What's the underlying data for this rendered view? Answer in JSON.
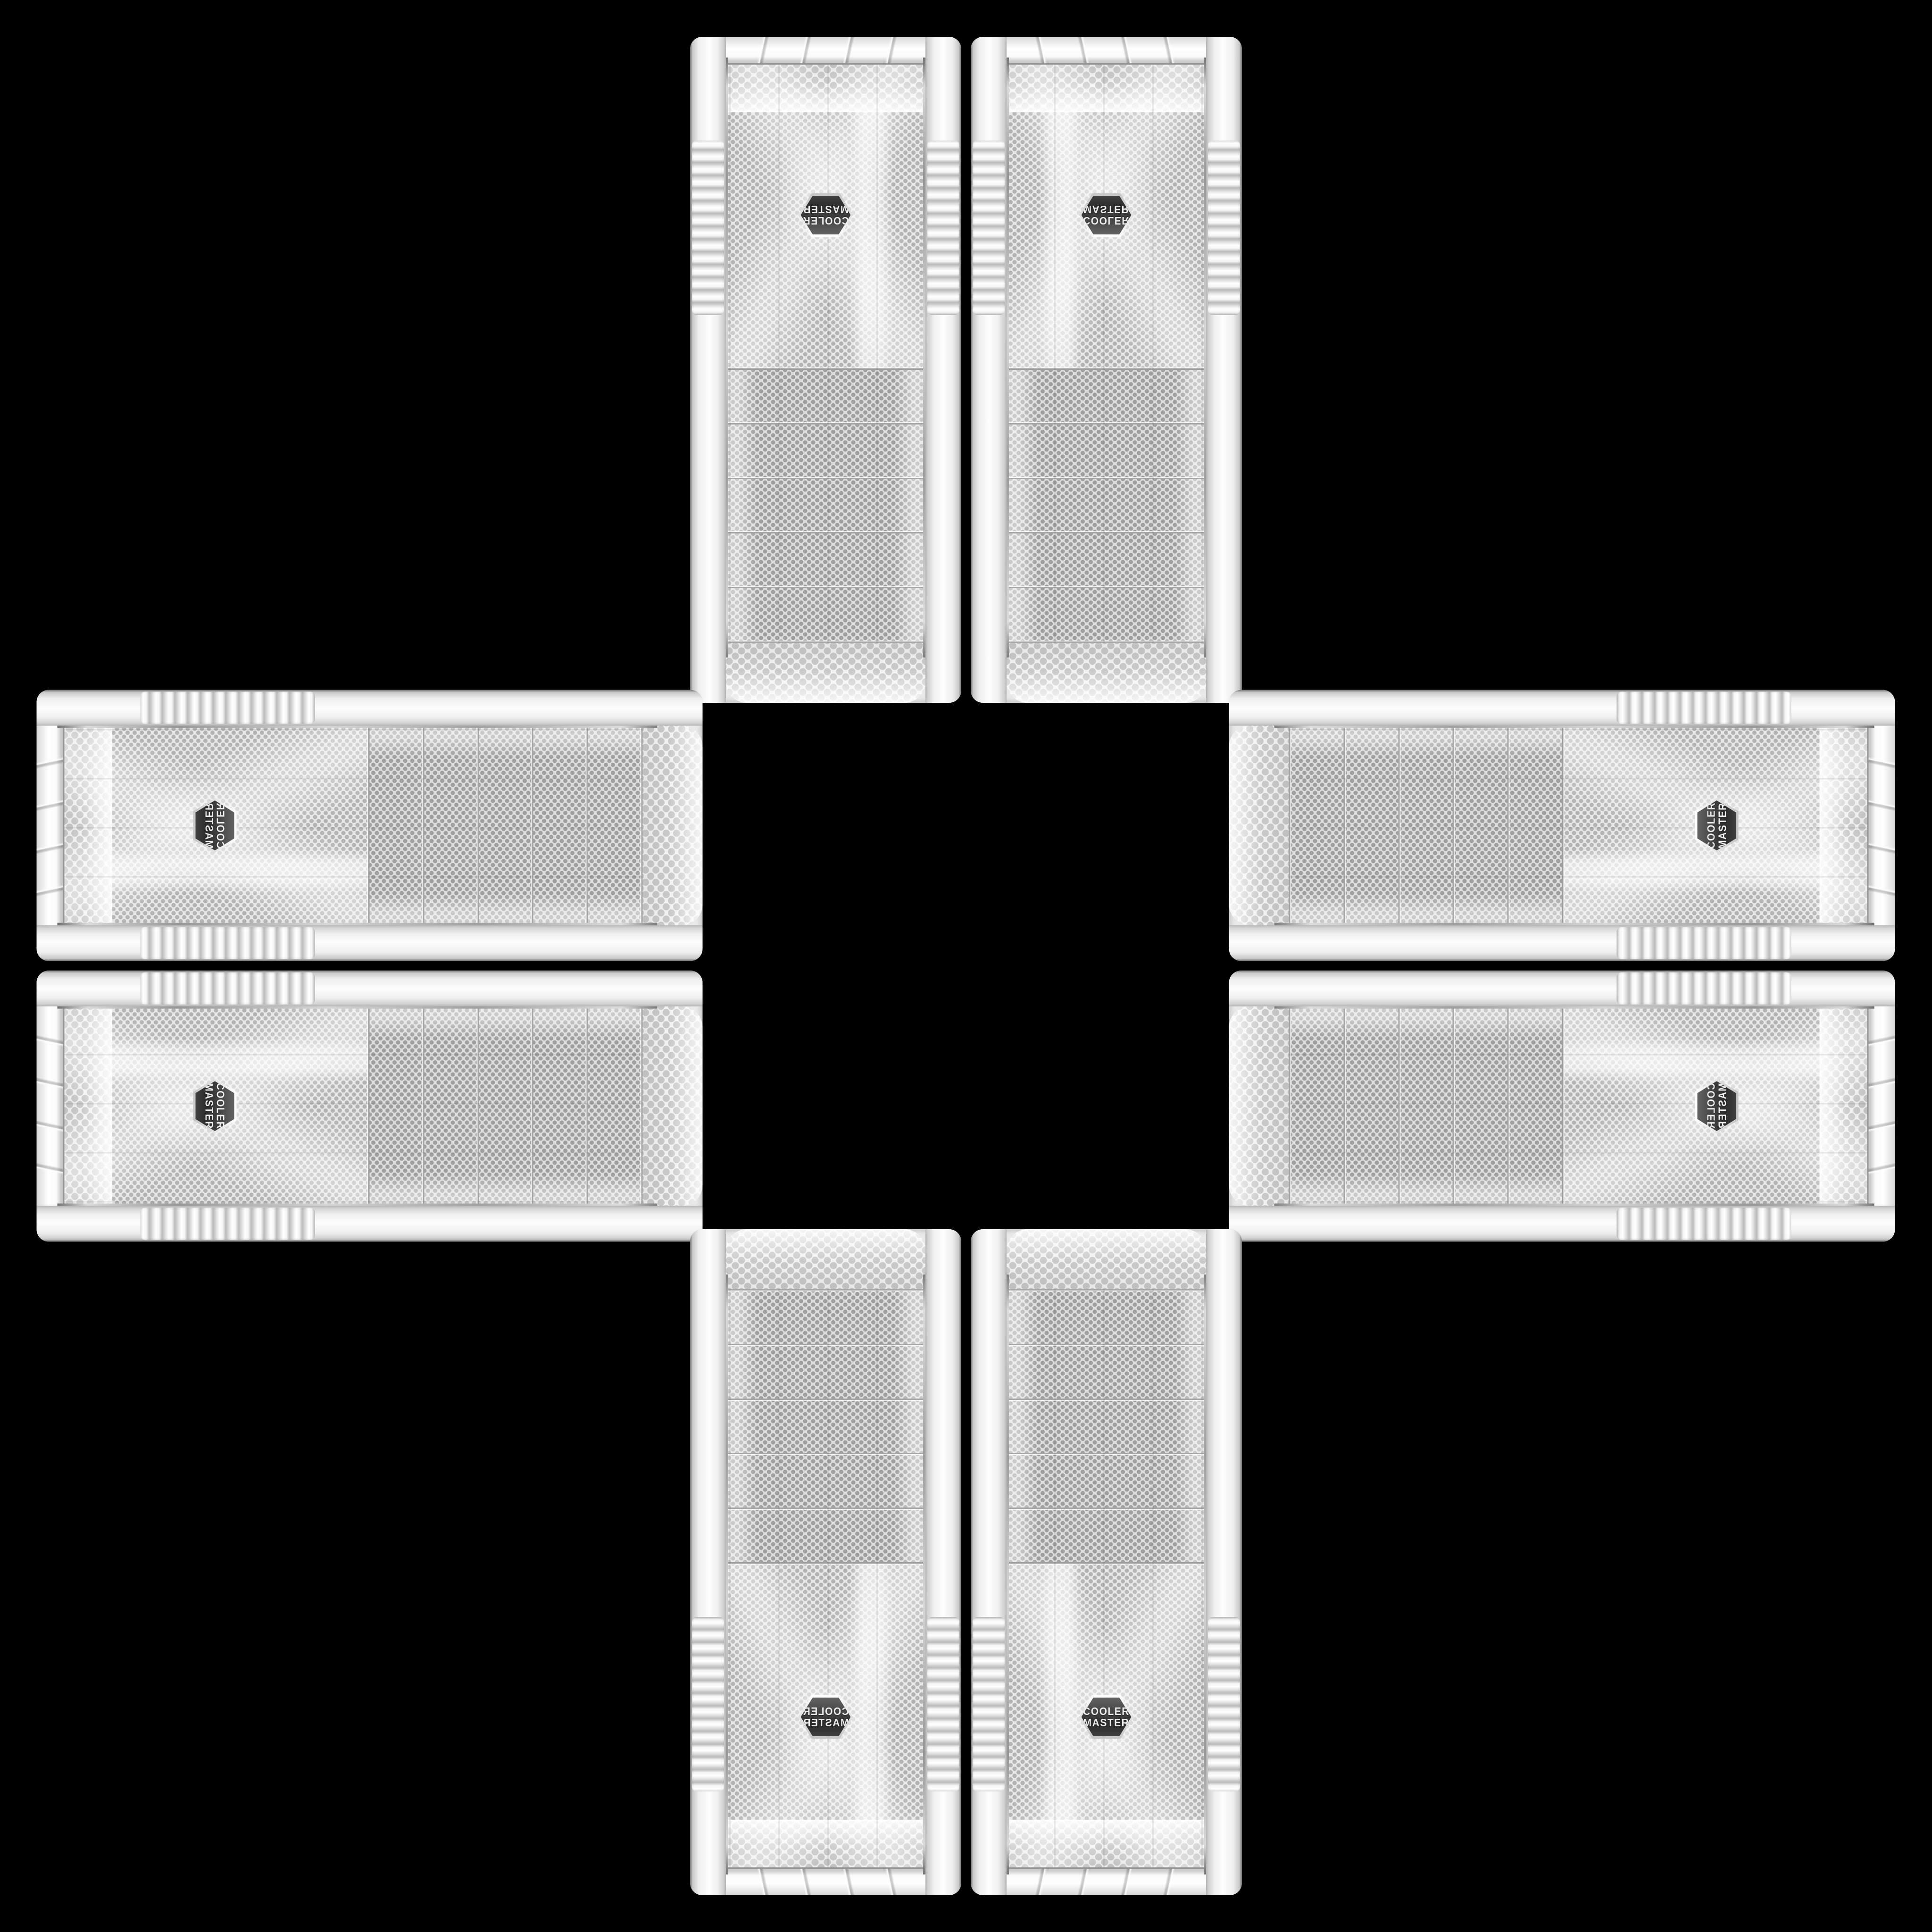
{
  "scene": {
    "background_color": "#000000",
    "layout": "eight identical white PC-case front panels arranged in a plus / cross pattern around an empty black center",
    "panel_count": 8
  },
  "badge": {
    "line1": "COOLER",
    "line2": "MASTER",
    "shape": "hexagon",
    "badge_color": "#3a3a3a",
    "text_color": "#ededed"
  },
  "panel": {
    "body_color": "#f1f1f1",
    "mesh_color": "#e7e7e7",
    "mesh_dot_color": "#b3b3b3",
    "slat_dot_color": "#9f9f9f",
    "trim_chrome_color": "#9a9a9a",
    "drive_bay_slats": 5
  },
  "panels": [
    {
      "id": "top-left",
      "group": "top",
      "orientation": "rotated-180"
    },
    {
      "id": "top-right",
      "group": "top",
      "orientation": "flipped-vertical"
    },
    {
      "id": "left-top",
      "group": "left",
      "orientation": "rotated-90-mirrored"
    },
    {
      "id": "left-bottom",
      "group": "left",
      "orientation": "rotated-90"
    },
    {
      "id": "right-top",
      "group": "right",
      "orientation": "rotated-270"
    },
    {
      "id": "right-bottom",
      "group": "right",
      "orientation": "rotated-270-mirrored"
    },
    {
      "id": "bottom-left",
      "group": "bottom",
      "orientation": "flipped-horizontal"
    },
    {
      "id": "bottom-right",
      "group": "bottom",
      "orientation": "upright"
    }
  ]
}
